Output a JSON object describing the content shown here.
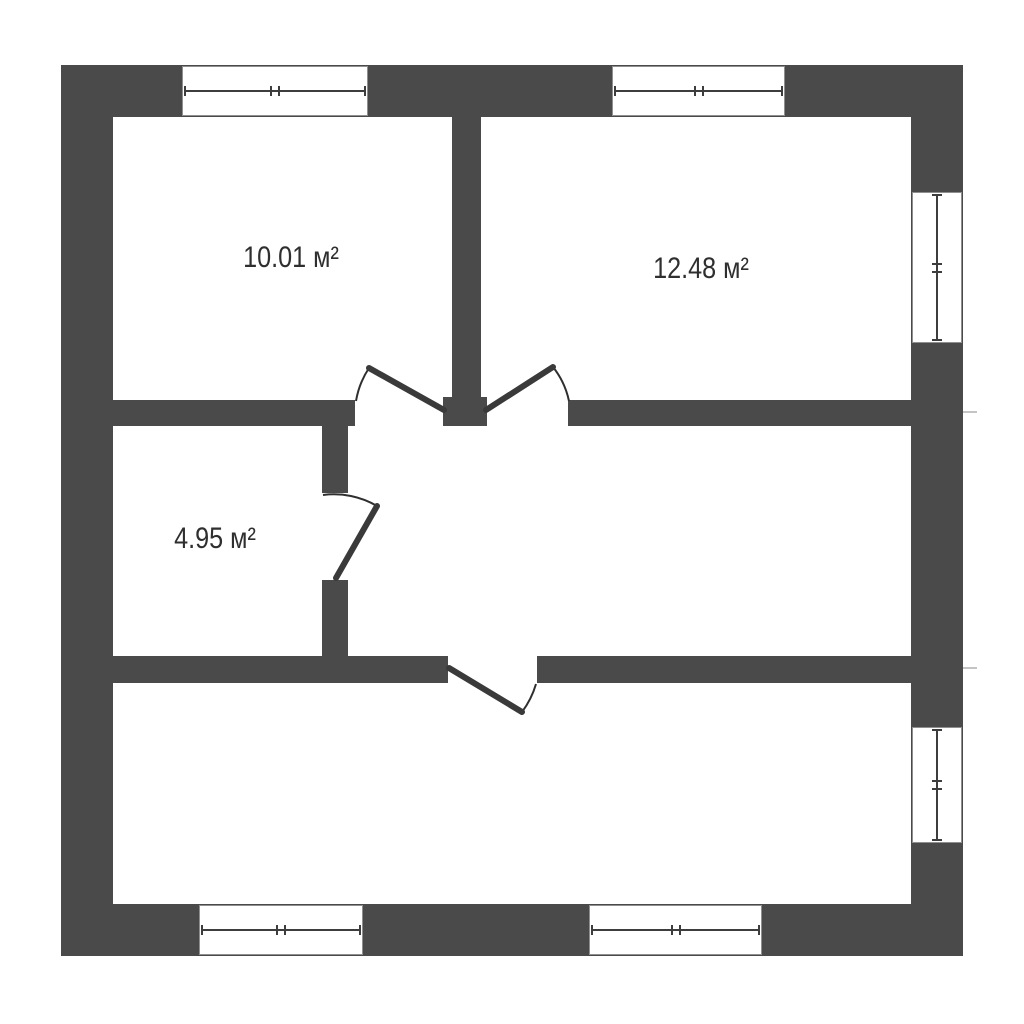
{
  "plan": {
    "type": "floor-plan",
    "rooms": [
      {
        "name": "room-top-left",
        "area_label": "10.01 м²"
      },
      {
        "name": "room-top-right",
        "area_label": "12.48 м²"
      },
      {
        "name": "room-middle-left",
        "area_label": "4.95 м²"
      },
      {
        "name": "room-bottom",
        "area_label": ""
      }
    ],
    "colors": {
      "wall": "#4a4a4a",
      "door_line": "#3a3a3a",
      "arc_line": "#2f2f2f",
      "window_frame": "#8f8f8f",
      "text": "#2f2f2f",
      "background": "#ffffff"
    },
    "counts": {
      "windows": 6,
      "doors": 4
    }
  }
}
